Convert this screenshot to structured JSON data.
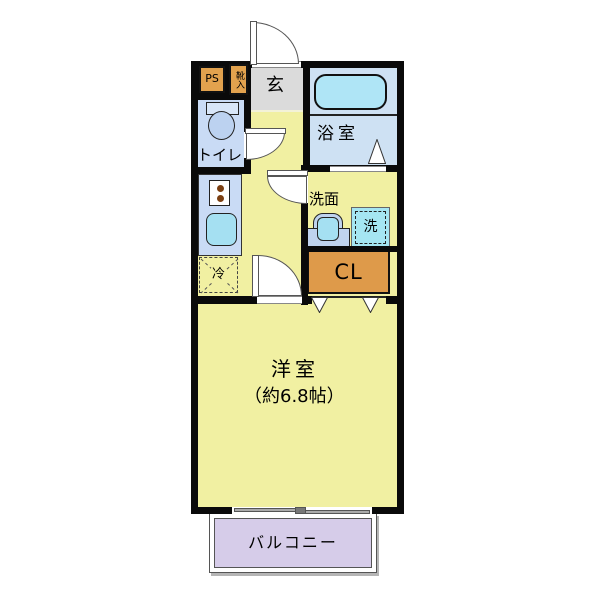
{
  "rooms": {
    "genkan": {
      "label": "玄"
    },
    "bathroom": {
      "label": "浴室"
    },
    "toilet": {
      "label": "トイレ"
    },
    "washroom": {
      "label": "洗面"
    },
    "western_room": {
      "label": "洋室",
      "size_note": "（約6.8帖）"
    },
    "balcony": {
      "label": "バルコニー"
    }
  },
  "fixtures": {
    "pipe_space": {
      "label": "PS"
    },
    "shoe_cabinet": {
      "label": "靴入"
    },
    "refrigerator_space": {
      "label": "冷"
    },
    "washer_space": {
      "label": "洗"
    },
    "closet": {
      "label": "CL"
    }
  },
  "colors": {
    "floor_yellow": "#f1f0a2",
    "water_blue": "#cee1f3",
    "toilet_blue": "#c9dbf5",
    "fixture_cyan": "#a5e0f2",
    "storage_orange": "#e2a24e",
    "closet_orange": "#de9a4a",
    "genkan_gray": "#dbdbdb",
    "balcony_lavender": "#d6cce9",
    "wall_black": "#0a0a0a"
  }
}
